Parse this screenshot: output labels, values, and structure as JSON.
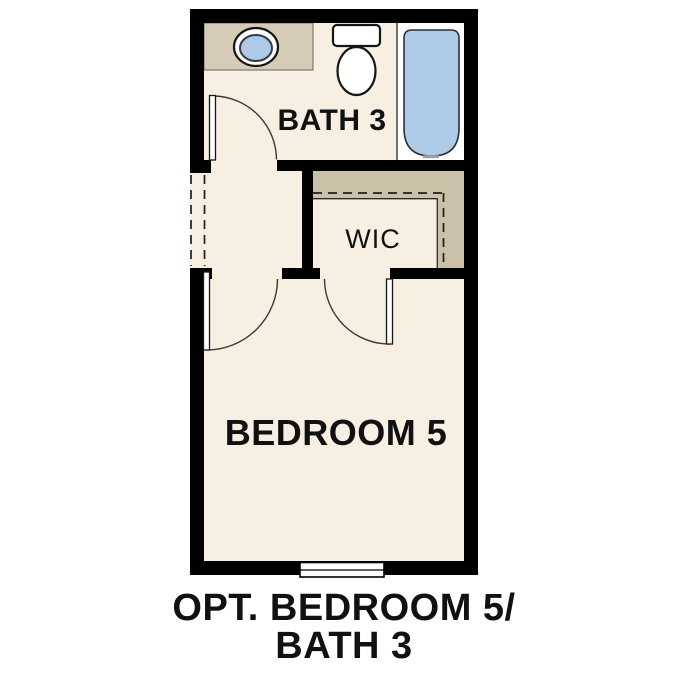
{
  "caption": {
    "line1": "OPT. BEDROOM 5/",
    "line2": "BATH 3"
  },
  "rooms": {
    "bath": {
      "label": "BATH 3"
    },
    "wic": {
      "label": "WIC"
    },
    "bedroom": {
      "label": "BEDROOM 5"
    }
  },
  "fixtures": {
    "sink": "oval-vanity-sink",
    "toilet": "toilet",
    "bathtub": "bathtub",
    "window": "bedroom-window",
    "doors": [
      "bath-door",
      "bedroom-door",
      "wic-door"
    ],
    "opening": "dashed-wall-opening"
  },
  "colors": {
    "wall": "#000000",
    "floor": "#f6efe2",
    "vanity_tan": "#d5cbb6",
    "closet_tan": "#cbc0a8",
    "water_blue": "#adcbe9",
    "fixture_white": "#ffffff",
    "text": "#111111"
  }
}
